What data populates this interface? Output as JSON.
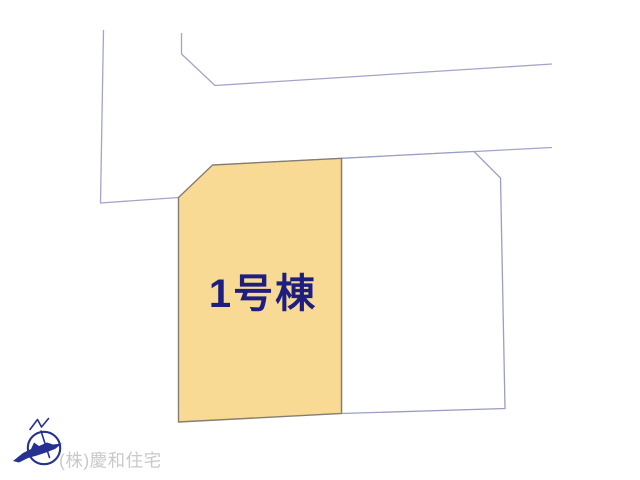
{
  "page": {
    "background_color": "#FFFFFF"
  },
  "site_plan": {
    "road_line_color": "#A2A5C7",
    "parcel_1": {
      "label": "1号棟",
      "fill_color": "#F8DA95",
      "border_color": "#857D70",
      "label_color": "#1E1E80"
    },
    "parcel_2": {
      "fill_color": "#FFFFFF",
      "border_color": "#9A9EC4"
    }
  },
  "compass": {
    "color": "#25318F"
  },
  "watermark": {
    "company": "(株)慶和住宅",
    "color": "#C9C9C9"
  }
}
